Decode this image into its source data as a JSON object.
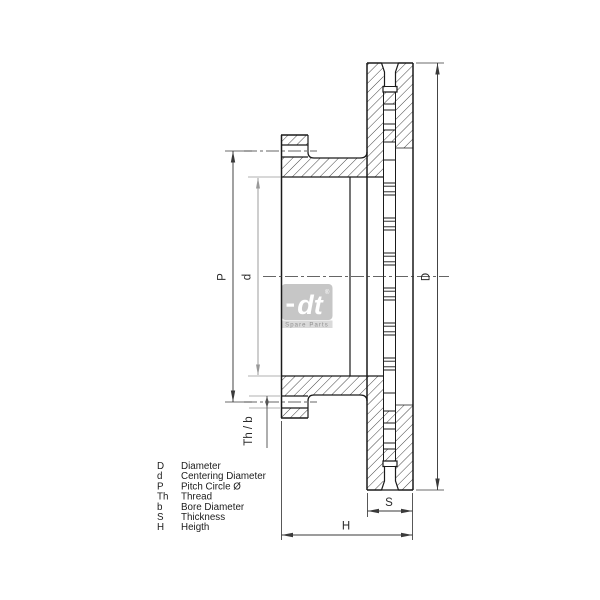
{
  "drawing": {
    "dimension_labels": {
      "D": "D",
      "d": "d",
      "P": "P",
      "Th_b": "Th / b",
      "S": "S",
      "H": "H"
    },
    "legend": {
      "rows": [
        {
          "symbol": "D",
          "label": "Diameter"
        },
        {
          "symbol": "d",
          "label": "Centering Diameter"
        },
        {
          "symbol": "P",
          "label": "Pitch Circle Ø"
        },
        {
          "symbol": "Th",
          "label": "Thread"
        },
        {
          "symbol": "b",
          "label": "Bore Diameter"
        },
        {
          "symbol": "S",
          "label": "Thickness"
        },
        {
          "symbol": "H",
          "label": "Heigth"
        }
      ]
    },
    "logo": {
      "text": "dt",
      "registered": "®",
      "subtext": "Spare Parts"
    },
    "colors": {
      "outline": "#1a1a1a",
      "dimension": "#3a3a3a",
      "dimension_light": "#999999",
      "watermark_box": "#c6c6c6",
      "watermark_strip": "#dadada",
      "background": "#ffffff"
    }
  }
}
